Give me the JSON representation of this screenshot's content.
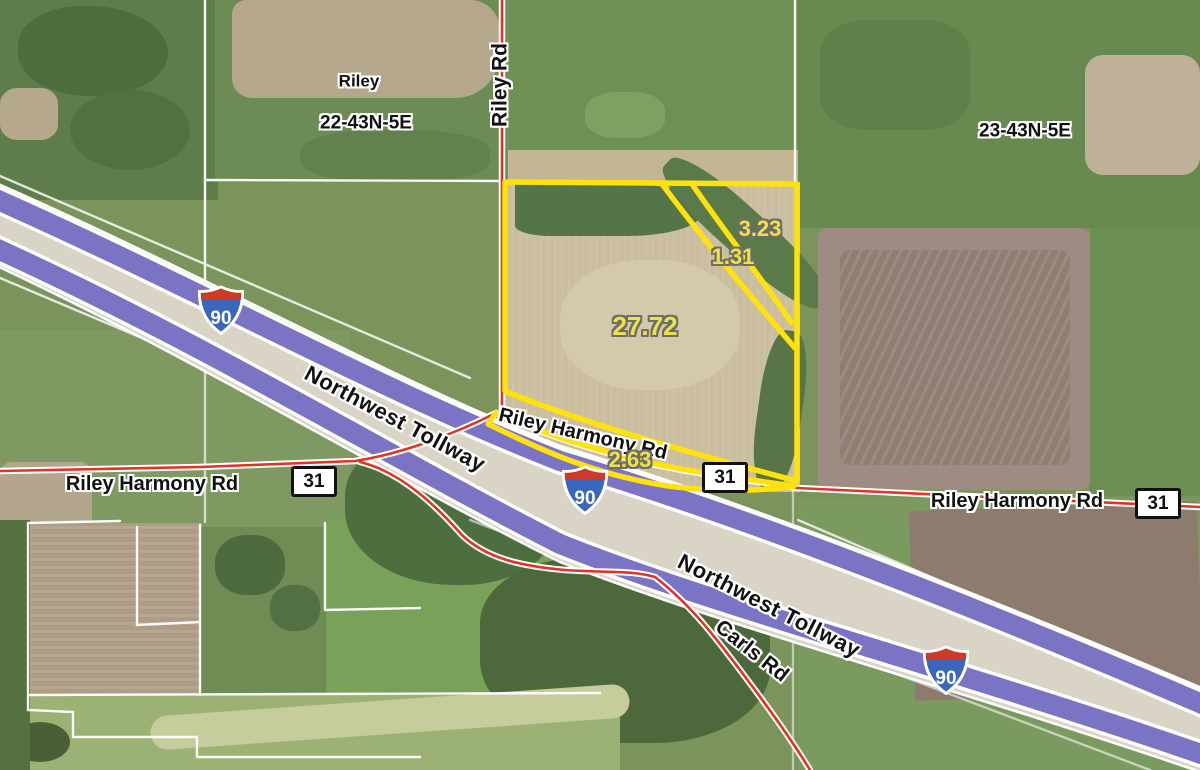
{
  "map": {
    "township_labels": [
      {
        "text": "Riley"
      },
      {
        "text": "22-43N-5E"
      },
      {
        "text": "23-43N-5E"
      }
    ],
    "road_labels": {
      "riley_rd": "Riley Rd",
      "riley_harmony_west": "Riley Harmony Rd",
      "riley_harmony_mid": "Riley Harmony Rd",
      "riley_harmony_east": "Riley Harmony Rd",
      "northwest_tollway_upper": "Northwest Tollway",
      "northwest_tollway_lower": "Northwest Tollway",
      "carls_rd": "Carls Rd"
    },
    "parcel_labels": [
      {
        "value": "3.23"
      },
      {
        "value": "1.31"
      },
      {
        "value": "27.72"
      },
      {
        "value": "2.63"
      }
    ],
    "shields": {
      "interstate": [
        {
          "number": "90"
        },
        {
          "number": "90"
        },
        {
          "number": "90"
        }
      ],
      "state_route": [
        {
          "number": "31"
        },
        {
          "number": "31"
        },
        {
          "number": "31"
        }
      ]
    },
    "colors": {
      "parcel_outline": "#FFE20A",
      "parcel_label_fill": "#EDE24A",
      "tollway_band": "#7B73C4",
      "road_red": "#E23323",
      "boundary_white": "#FFFFFF",
      "interstate_blue": "#3A66BB",
      "interstate_red": "#CE3A28"
    }
  }
}
